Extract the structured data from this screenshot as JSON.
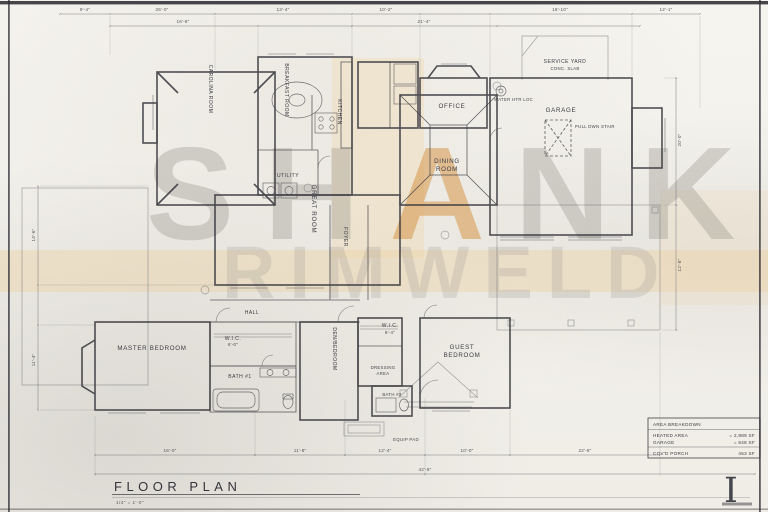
{
  "sheet": {
    "title": "FLOOR PLAN",
    "scale": "1/4\" = 1'-0\"",
    "monogram": "I"
  },
  "watermark": {
    "part1": "SH",
    "part2": "A",
    "part3": "NK",
    "line2": "RIMWELD",
    "accent_color": "#d59648"
  },
  "area_table": {
    "header": "AREA BREAKDOWN",
    "rows": [
      {
        "label": "HEATED AREA",
        "value": "= 2,989 SF"
      },
      {
        "label": "GARAGE",
        "value": "= 848 SF"
      },
      {
        "label": "COV'D PORCH",
        "value": "453 SF"
      }
    ]
  },
  "rooms": {
    "master_bedroom": "MASTER BEDROOM",
    "hall": "HALL",
    "wic_master": "W.I.C.",
    "bath1": "BATH #1",
    "den_bedroom": "DEN/BEDROOM",
    "foyer": "FOYER",
    "great_room": "GREAT ROOM",
    "dining_1": "DINING",
    "dining_2": "ROOM",
    "carolina_room": "CAROLINA ROOM",
    "breakfast_room": "BREAKFAST ROOM",
    "kitchen": "KITCHEN",
    "utility": "UTILITY",
    "office": "OFFICE",
    "garage": "GARAGE",
    "service_yard": "SERVICE YARD",
    "service_yard_sub": "CONC. SLAB",
    "wic_guest": "W.I.C.",
    "dressing_1": "DRESSING",
    "dressing_2": "AREA",
    "bath2": "BATH #2",
    "guest_1": "GUEST",
    "guest_2": "BEDROOM",
    "pull_dwn_stair": "PULL DWN STAIR",
    "water_htr": "WATER HTR LOC",
    "equip_pad": "EQUIP PAD"
  },
  "dims": {
    "t1": "9'-4\"",
    "t2": "26'-0\"",
    "t3": "13'-4\"",
    "t4": "10'-2\"",
    "t5": "18'-10\"",
    "t6": "12'-1\"",
    "s1": "16'-8\"",
    "s2": "21'-4\"",
    "b1": "16'-0\"",
    "b2": "11'-8\"",
    "b3": "12'-4\"",
    "b4": "10'-0\"",
    "b5": "22'-8\"",
    "b6": "42'-8\"",
    "l1": "14'-6\"",
    "l2": "11'-4\"",
    "r1": "20'-0\"",
    "r2": "12'-8\"",
    "wic_master": "6'-0\"",
    "wic_guest": "8'-4\""
  }
}
